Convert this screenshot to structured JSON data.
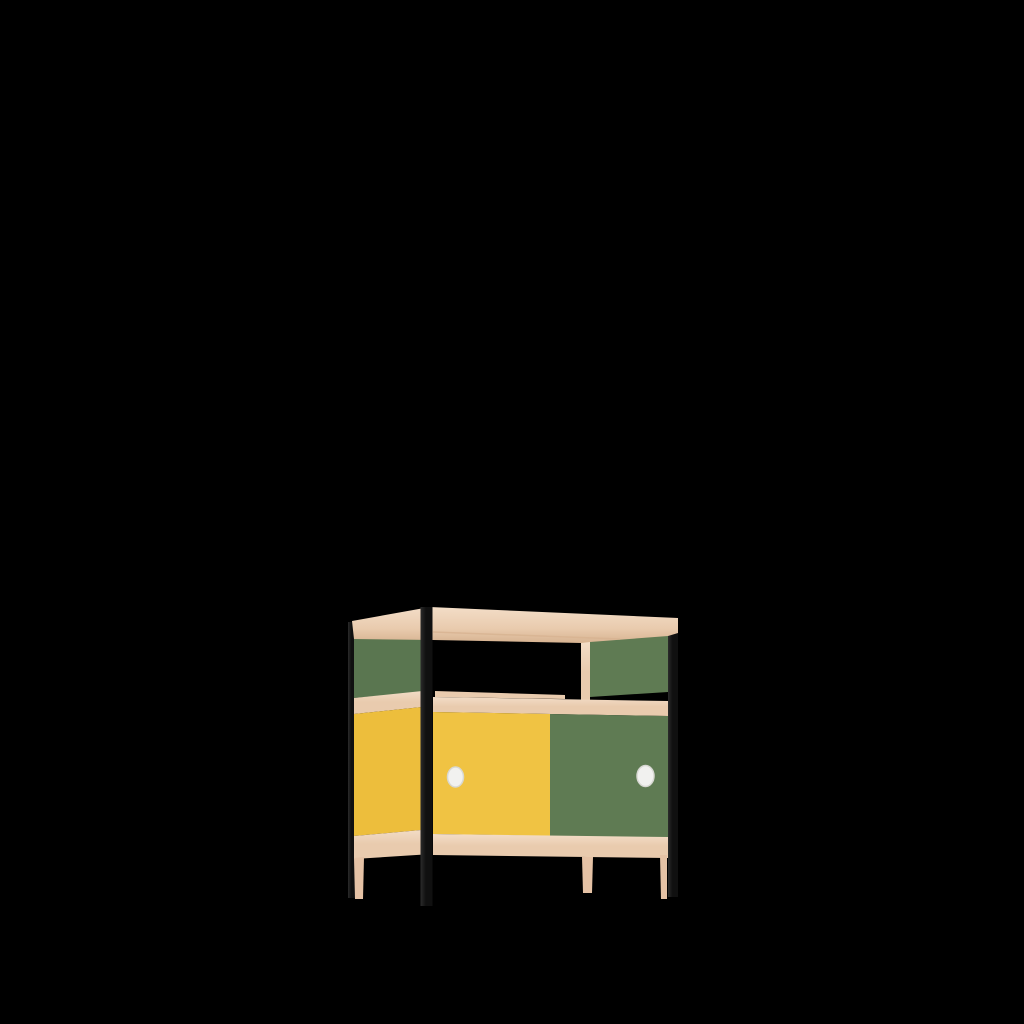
{
  "scene": {
    "object_label": "sideboard cabinet render",
    "description": "3D product render of a two-door sideboard with open top shelf, wooden frame, black round legs, green and yellow panels, white round knobs, centered low on a black background",
    "background_color": "#000000",
    "colors": {
      "background": "#000000",
      "wood_light": "#F3DDC7",
      "wood": "#E9CBAE",
      "wood_dark": "#D7B391",
      "wood_leg": "#E5C2A5",
      "green": "#5F7B53",
      "green_side": "#5A7650",
      "yellow": "#F0C343",
      "yellow_side": "#EDBE3C",
      "frame_black": "#101010",
      "frame_black_light": "#2B2B2B",
      "knob": "#F1F1EF",
      "knob_shadow": "#D8D8D3"
    }
  }
}
